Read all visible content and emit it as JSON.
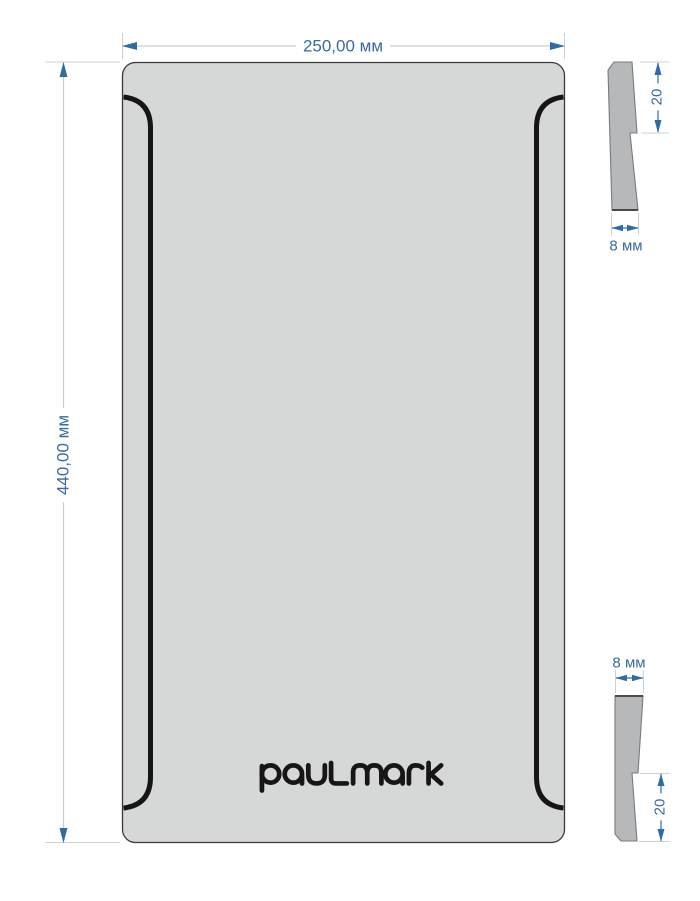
{
  "drawing": {
    "brand_logo_text": "paulmark",
    "dimensions": {
      "plate_width_label": "250,00 мм",
      "plate_height_label": "440,00 мм",
      "top_profile_lip_label": "20",
      "top_profile_thickness_label": "8 мм",
      "bottom_profile_thickness_label": "8 мм",
      "bottom_profile_lip_label": "20"
    },
    "colors": {
      "dimension_text_blue": "#3a6b9e",
      "dimension_arrow_blue": "#2e6da4",
      "extension_line_gray": "#cdd1d5",
      "plate_fill_gray": "#d6d7d7",
      "plate_outline": "#3a3a3a",
      "profile_fill_gray": "#b6b8ba",
      "groove_black": "#151515"
    }
  }
}
